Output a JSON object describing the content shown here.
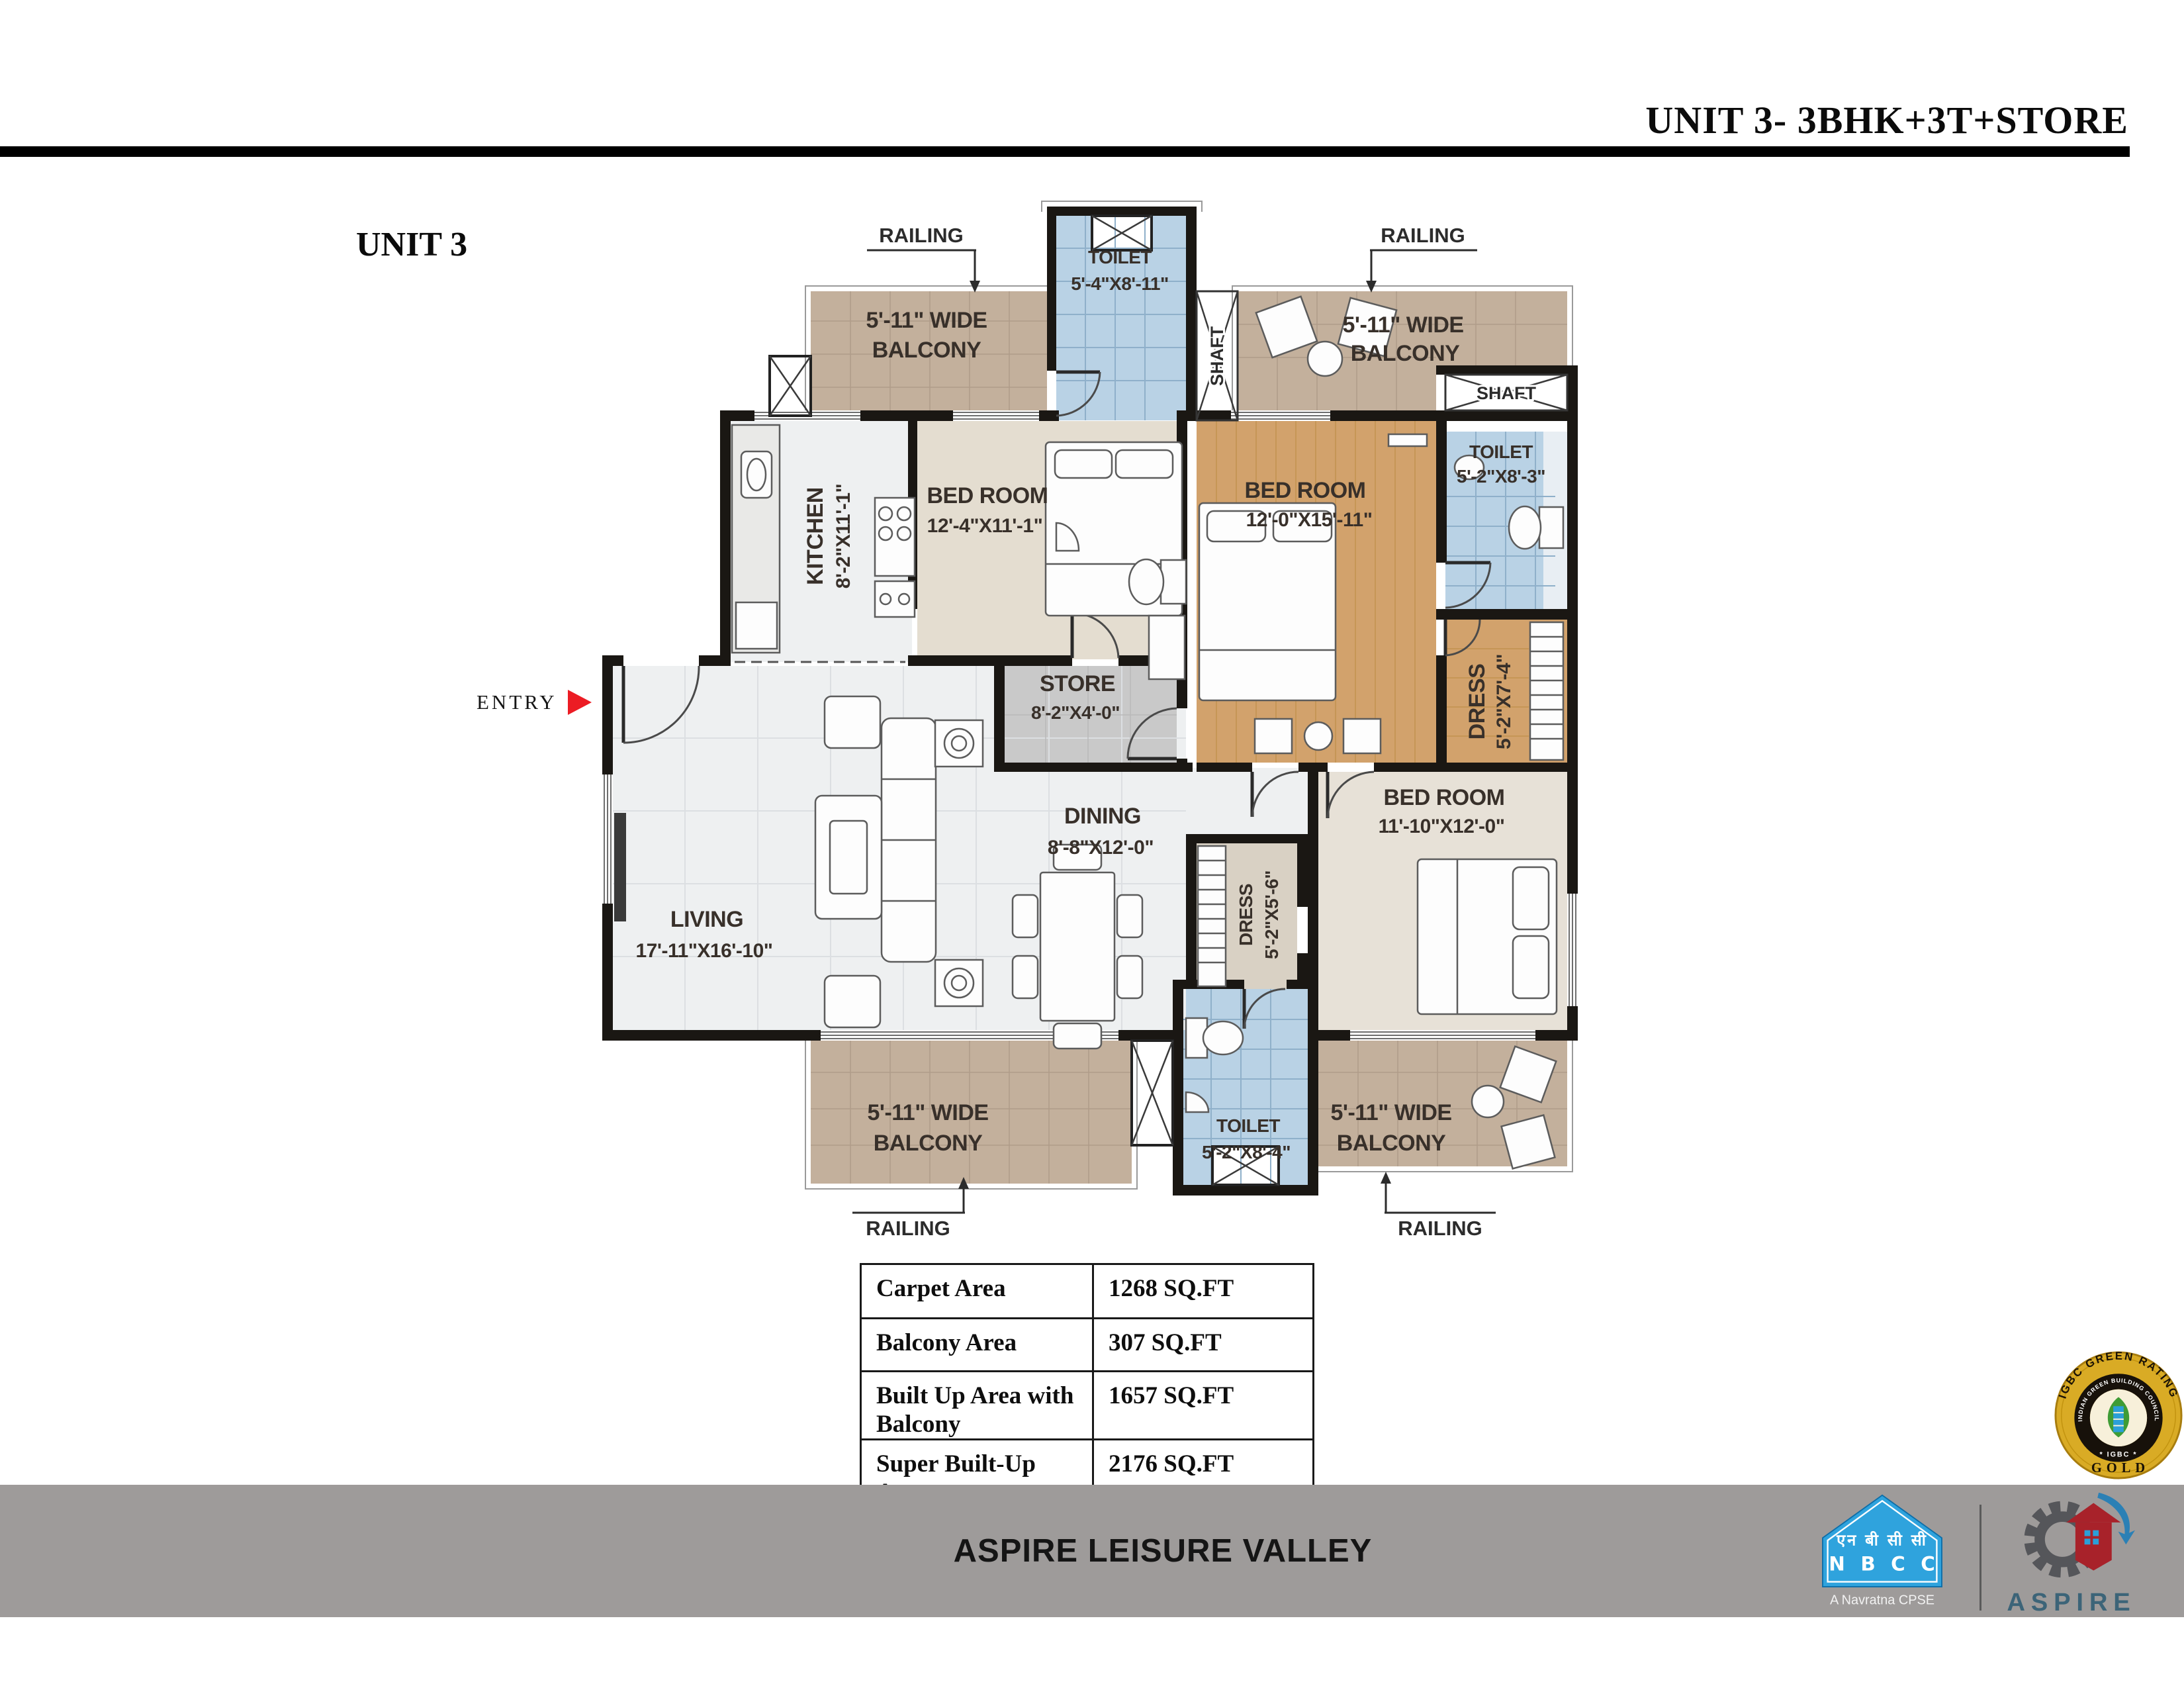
{
  "header": {
    "title": "UNIT 3- 3BHK+3T+STORE"
  },
  "plan": {
    "unit_label": "UNIT 3",
    "entry_label": "ENTRY",
    "railings": [
      "RAILING",
      "RAILING",
      "RAILING",
      "RAILING"
    ],
    "shafts": {
      "top": "SHAFT",
      "right": "SHAFT"
    },
    "rooms": {
      "toilet_top": {
        "name": "TOILET",
        "dim": "5'-4\"X8'-11\""
      },
      "balcony_top_left": {
        "line1": "5'-11\" WIDE",
        "line2": "BALCONY"
      },
      "balcony_top_right": {
        "line1": "5'-11\" WIDE",
        "line2": "BALCONY"
      },
      "kitchen": {
        "name": "KITCHEN",
        "dim": "8'-2\"X11'-1\""
      },
      "bedroom_top_left": {
        "name": "BED ROOM",
        "dim": "12'-4\"X11'-1\""
      },
      "bedroom_top_right": {
        "name": "BED ROOM",
        "dim": "12'-0\"X15'-11\""
      },
      "toilet_right": {
        "name": "TOILET",
        "dim": "5'-2\"X8'-3\""
      },
      "dress_right": {
        "name": "DRESS",
        "dim": "5'-2\"X7'-4\""
      },
      "store": {
        "name": "STORE",
        "dim": "8'-2\"X4'-0\""
      },
      "dining": {
        "name": "DINING",
        "dim": "8'-8\"X12'-0\""
      },
      "living": {
        "name": "LIVING",
        "dim": "17'-11\"X16'-10\""
      },
      "bedroom_right": {
        "name": "BED ROOM",
        "dim": "11'-10\"X12'-0\""
      },
      "dress_mid": {
        "name": "DRESS",
        "dim": "5'-2\"X5'-6\""
      },
      "toilet_bottom": {
        "name": "TOILET",
        "dim": "5'-2\"X8'-4\""
      },
      "balcony_bottom_left": {
        "line1": "5'-11\" WIDE",
        "line2": "BALCONY"
      },
      "balcony_bottom_right": {
        "line1": "5'-11\" WIDE",
        "line2": "BALCONY"
      }
    }
  },
  "area_table": {
    "rows": [
      {
        "label": "Carpet Area",
        "value": "1268 SQ.FT"
      },
      {
        "label": "Balcony Area",
        "value": "307 SQ.FT"
      },
      {
        "label": "Built Up Area with Balcony",
        "value": "1657 SQ.FT"
      },
      {
        "label": "Super Built-Up Area",
        "value": "2176 SQ.FT"
      }
    ]
  },
  "badge": {
    "arc_text": "IGBC GREEN RATING",
    "ring_text": "INDIAN GREEN BUILDING COUNCIL",
    "ring_bottom": "* IGBC *",
    "rating": "GOLD"
  },
  "footer": {
    "project_name": "ASPIRE LEISURE VALLEY",
    "nbcc": {
      "hindi": "एन बी सी सी",
      "acronym": "N B C C",
      "tagline": "A Navratna CPSE"
    },
    "aspire": {
      "wordmark": "ASPIRE"
    }
  },
  "colors": {
    "accent_red": "#ec1c24",
    "footer_gray": "#9e9b9a",
    "nbcc_blue": "#2fa3dd",
    "badge_gold": "#d9ab25"
  }
}
